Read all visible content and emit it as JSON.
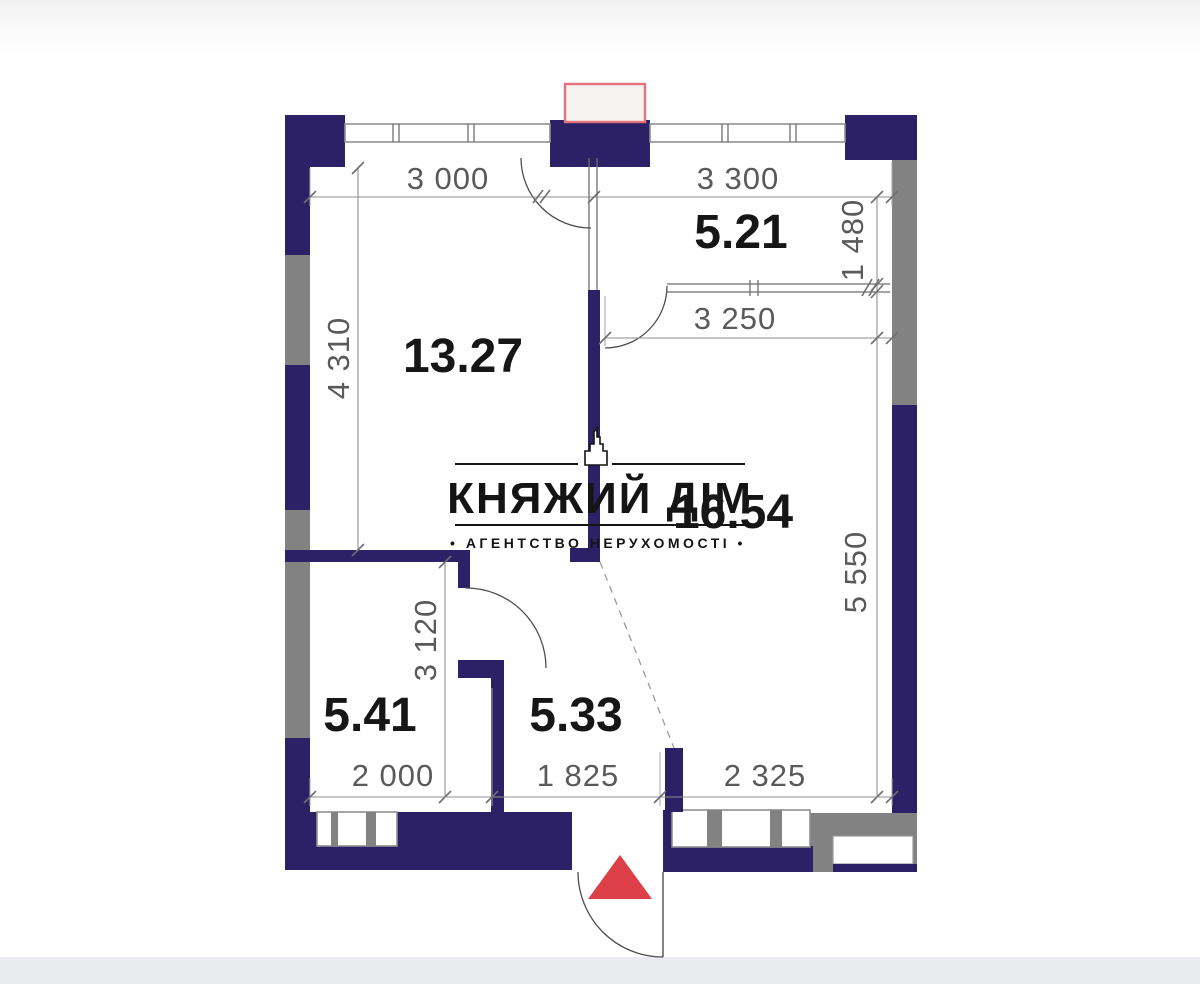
{
  "colors": {
    "wall-navy": "#2c2166",
    "wall-gray": "#828282",
    "line-gray": "#8f8f8f",
    "dim-text": "#5a5a5a",
    "room-text": "#161616",
    "accent-red": "#dd3f48",
    "red-rect-border": "#e4737c",
    "red-rect-fill": "#f6f2f0",
    "bg": "#ffffff",
    "bottom-strip": "#e9ebee",
    "top-strip": "#f3f2f2",
    "watermark": "#141414"
  },
  "watermark": {
    "title": "КНЯЖИЙ ДІМ",
    "subtitle": "• АГЕНТСТВО НЕРУХОМОСТІ •"
  },
  "rooms": [
    {
      "id": "room-13-27",
      "area": "13.27"
    },
    {
      "id": "room-5-21",
      "area": "5.21"
    },
    {
      "id": "room-16-54",
      "area": "16.54"
    },
    {
      "id": "room-5-41",
      "area": "5.41"
    },
    {
      "id": "room-5-33",
      "area": "5.33"
    }
  ],
  "dimensions": {
    "top_left": "3 000",
    "top_right": "3 300",
    "left": "4 310",
    "right_upper": "1 480",
    "mid_right": "3 250",
    "right_lower": "5 550",
    "mid_left": "3 120",
    "bottom_left": "2 000",
    "bottom_center": "1 825",
    "bottom_right": "2 325"
  }
}
